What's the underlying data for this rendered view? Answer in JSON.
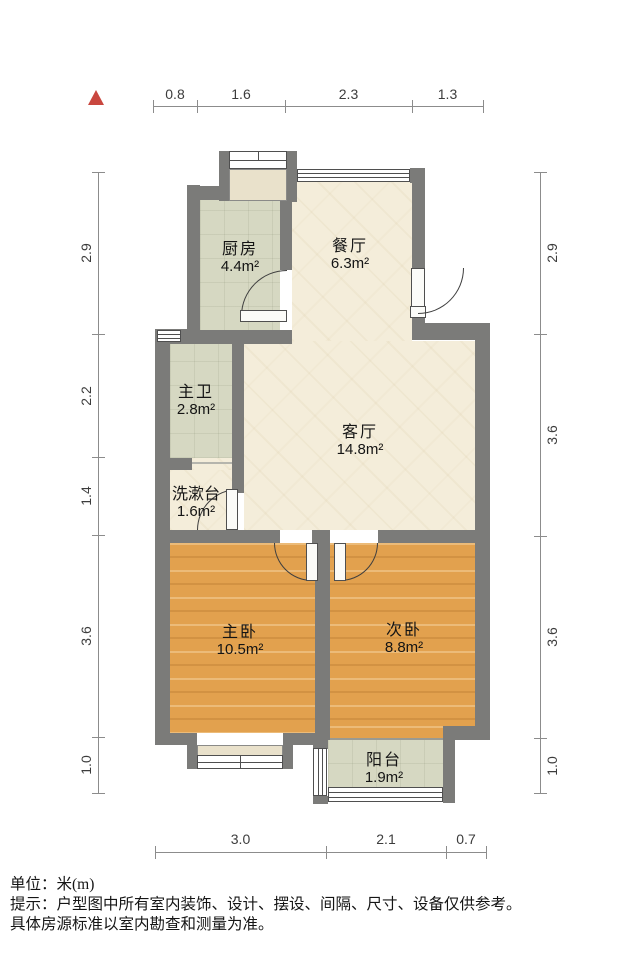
{
  "rooms": {
    "kitchen": {
      "name": "厨房",
      "area": "4.4m²"
    },
    "dining": {
      "name": "餐厅",
      "area": "6.3m²"
    },
    "master_bath": {
      "name": "主卫",
      "area": "2.8m²"
    },
    "living": {
      "name": "客厅",
      "area": "14.8m²"
    },
    "washstand": {
      "name": "洗漱台",
      "area": "1.6m²"
    },
    "master_bedroom": {
      "name": "主卧",
      "area": "10.5m²"
    },
    "second_bedroom": {
      "name": "次卧",
      "area": "8.8m²"
    },
    "balcony": {
      "name": "阳台",
      "area": "1.9m²"
    }
  },
  "dims": {
    "top": [
      "0.8",
      "1.6",
      "2.3",
      "1.3"
    ],
    "bottom": [
      "3.0",
      "2.1",
      "0.7"
    ],
    "left": [
      "2.9",
      "2.2",
      "1.4",
      "3.6",
      "1.0"
    ],
    "right": [
      "2.9",
      "3.6",
      "3.6",
      "1.0"
    ]
  },
  "footer": {
    "unit": "单位：米(m)",
    "note1": "提示：户型图中所有室内装饰、设计、摆设、间隔、尺寸、设备仅供参考。",
    "note2": "具体房源标准以室内勘查和测量为准。"
  },
  "colors": {
    "wall": "#7b7b79",
    "wood_floor": "#e2a14e",
    "tile_floor": "#d6d8c2",
    "marble_floor": "#f4edda",
    "north_indicator": "#c9473f"
  }
}
